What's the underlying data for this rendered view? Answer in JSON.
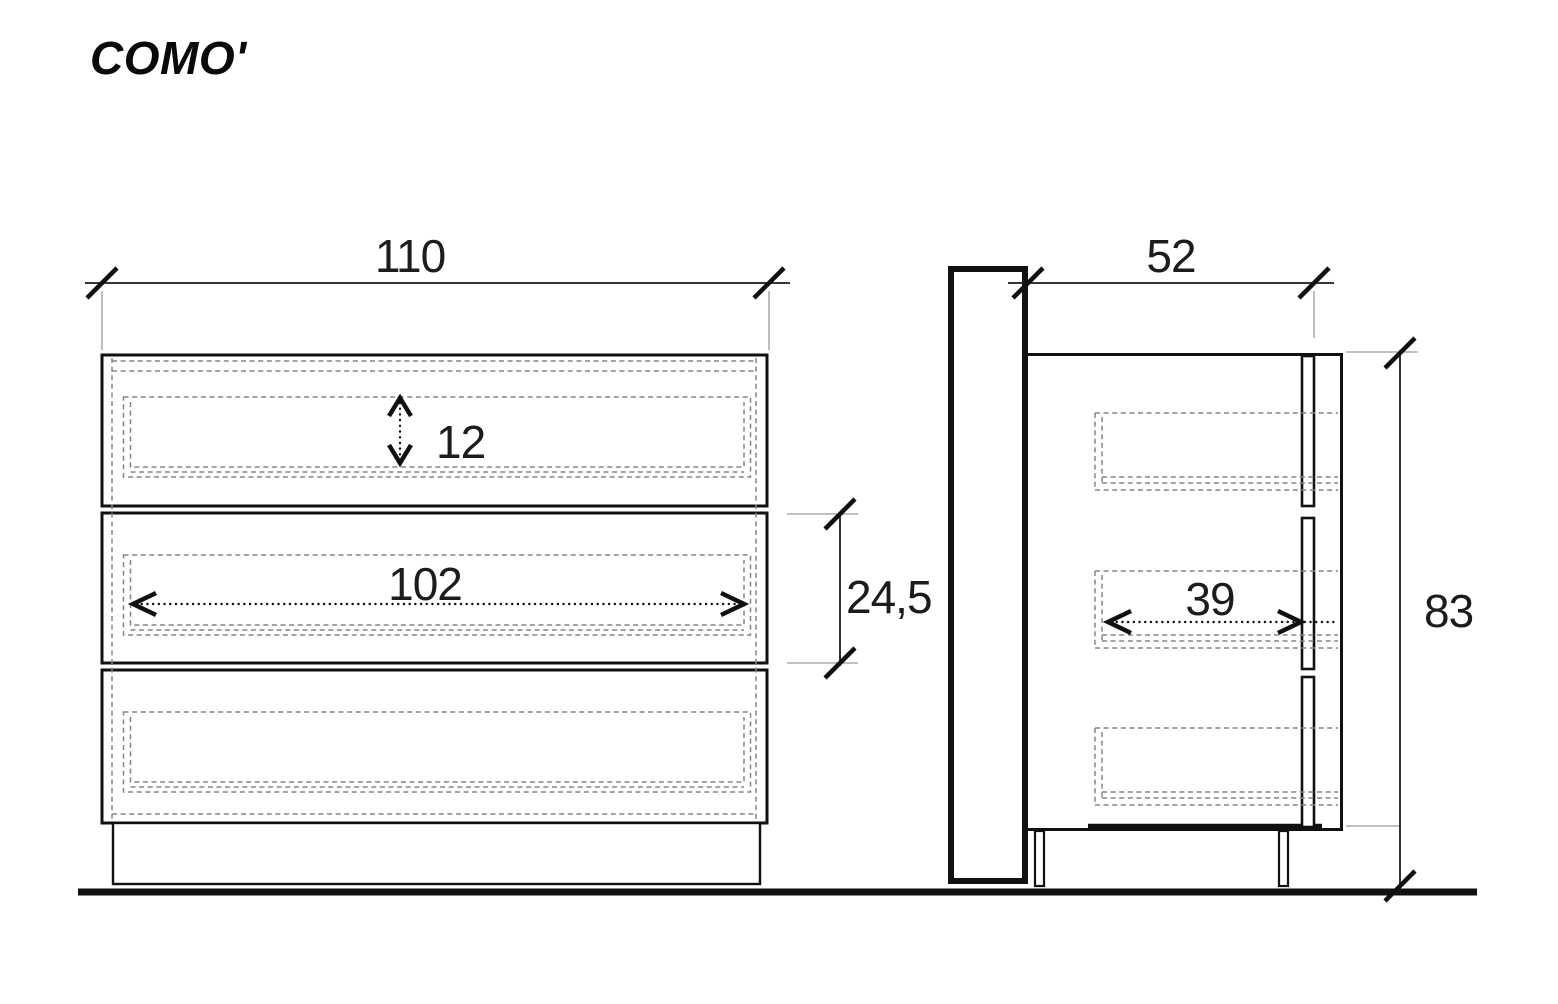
{
  "title": "COMO'",
  "drawing": {
    "kind": "furniture-technical-drawing",
    "views": [
      "front",
      "side"
    ],
    "units": "cm"
  },
  "dimensions": {
    "total_width": "110",
    "total_depth": "52",
    "total_height": "83",
    "drawer_inner_height": "12",
    "drawer_inner_width": "102",
    "drawer_front_height": "24,5",
    "drawer_inner_depth": "39"
  },
  "colors": {
    "ink": "#111111",
    "hidden_line": "#868686",
    "extension_line": "#9a9a9a",
    "dimension_text": "#1c1c1c",
    "background": "#ffffff"
  }
}
